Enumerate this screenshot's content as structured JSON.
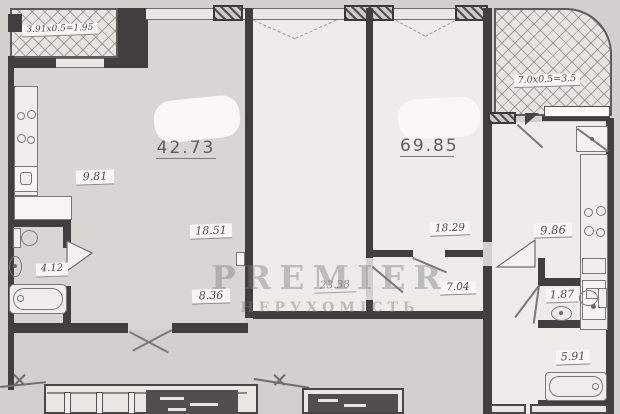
{
  "watermark": {
    "line1": "PREMIER",
    "line2": "НЕРУХОМІСТЬ"
  },
  "balconies": {
    "left": {
      "label": "3.91x0.5=1.95"
    },
    "right": {
      "label": "7.0x0.5=3.5"
    }
  },
  "totals": {
    "left_unit": "42.73",
    "right_unit": "69.85"
  },
  "rooms": {
    "kitchen_left": "9.81",
    "room_left": "18.51",
    "hall_left": "8.36",
    "bath_left": "4.12",
    "living_middle": "23.38",
    "bedroom_middle": "18.29",
    "corridor": "7.04",
    "kitchen_right": "9.86",
    "wc_right": "1.87",
    "bath_right": "5.91"
  },
  "colors": {
    "paper": "#d1d0cd",
    "room_fill": "#edece8",
    "wall": "#403f3d",
    "hatch_fill": "#e7e5e0",
    "dark_window": "#504f4c"
  }
}
